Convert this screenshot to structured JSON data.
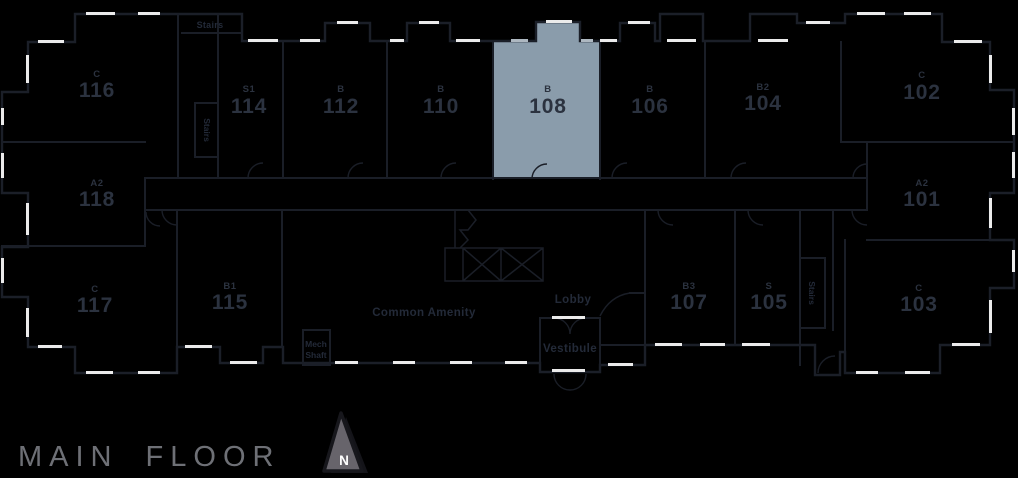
{
  "floor": {
    "label": "MAIN FLOOR"
  },
  "compass": {
    "label": "N"
  },
  "highlight": {
    "unit_number": "108",
    "color": "#8A9CAB"
  },
  "colors": {
    "background": "#000000",
    "wall": "#1b1f28",
    "window": "#ebebeb",
    "unit_label": "#2b323f",
    "highlight_fill": "#8A9CAB",
    "floor_title": "#6e7076",
    "compass_fill": "#67646b"
  },
  "units": [
    {
      "code": "C",
      "number": "116"
    },
    {
      "code": "S1",
      "number": "114"
    },
    {
      "code": "B",
      "number": "112"
    },
    {
      "code": "B",
      "number": "110"
    },
    {
      "code": "B",
      "number": "108",
      "highlighted": true
    },
    {
      "code": "B",
      "number": "106"
    },
    {
      "code": "B2",
      "number": "104"
    },
    {
      "code": "C",
      "number": "102"
    },
    {
      "code": "A2",
      "number": "118"
    },
    {
      "code": "A2",
      "number": "101"
    },
    {
      "code": "C",
      "number": "117"
    },
    {
      "code": "B1",
      "number": "115"
    },
    {
      "code": "B3",
      "number": "107"
    },
    {
      "code": "S",
      "number": "105"
    },
    {
      "code": "C",
      "number": "103"
    }
  ],
  "rooms": {
    "stairs_top": "Stairs",
    "stairs_left": "Stairs",
    "stairs_right": "Stairs",
    "mech_line1": "Mech",
    "mech_line2": "Shaft",
    "common_amenity": "Common Amenity",
    "lobby": "Lobby",
    "vestibule": "Vestibule"
  }
}
